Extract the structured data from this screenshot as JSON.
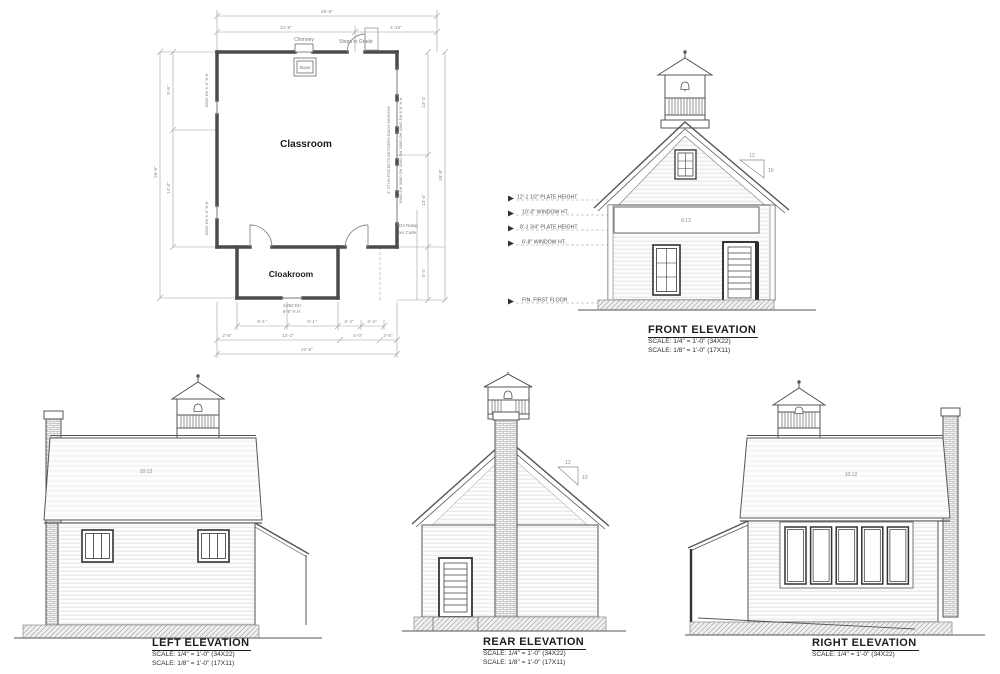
{
  "sheet": {
    "background": "#ffffff",
    "line_color": "#4b4b4b",
    "dim_color": "#9a9a9a"
  },
  "floor_plan": {
    "classroom_label": "Classroom",
    "cloakroom_label": "Cloakroom",
    "stove_label": "Stove",
    "chimney_label": "Chimney",
    "steps_label": "Steps to Grade",
    "ada_ramp_line1": "ADA Ramp",
    "ada_ramp_line2": "per Code",
    "cloak_window_line1": "24/50 DH",
    "cloak_window_line2": "6'-8\" H.H.",
    "left_window_note_top": "30/30 DH  5'-0\" H.H.",
    "left_window_note_bottom": "30/30 DH  5'-0\" H.H.",
    "right_wall_note": "3\" STUD POCKETS BETWEEN EACH WINDOW",
    "right_window_note": "30/60 DH  30/60 DH  30/60 DH  30/60 DH  30/60 DH   6'-8\" H.H.",
    "dims": {
      "top_overall": "26'-6\"",
      "top_left": "21'-8\"",
      "top_right": "4'-10\"",
      "left_outer": "26'-6\"",
      "left_seg1": "5'-6\"",
      "left_seg2": "14'-0\"",
      "right_seg1": "13'-4\"",
      "right_seg2": "13'-4\"",
      "right_lower": "4'-4\"",
      "right_outer": "26'-8\"",
      "bottom_r1_a": "6'-1\"",
      "bottom_r1_b": "6'-1\"",
      "bottom_r1_c": "2'-4\"",
      "bottom_r1_d": "2'-4\"",
      "bottom_r2_a": "2'-8\"",
      "bottom_r2_b": "12'-2\"",
      "bottom_r2_c": "5'-0\"",
      "bottom_r2_d": "2'-8\"",
      "bottom_overall": "22'-6\""
    }
  },
  "front_elevation": {
    "title": "FRONT ELEVATION",
    "scale_1": "SCALE:  1/4\" = 1'-0\" (34X22)",
    "scale_2": "SCALE:  1/8\" = 1'-0\" (17X11)",
    "band_label": "6:12",
    "pitch_rise": "12",
    "pitch_run": "10",
    "annotations": [
      "12'-1 1/2\" PLATE HEIGHT",
      "10'-0\" WINDOW HT.",
      "8'-1 3/4\" PLATE HEIGHT",
      "6'-8\" WINDOW HT.",
      "FIN. FIRST FLOOR"
    ]
  },
  "left_elevation": {
    "title": "LEFT ELEVATION",
    "scale_1": "SCALE:  1/4\" = 1'-0\" (34X22)",
    "scale_2": "SCALE:  1/8\" = 1'-0\" (17X11)",
    "roof_slope": "10:12"
  },
  "rear_elevation": {
    "title": "REAR ELEVATION",
    "scale_1": "SCALE:  1/4\" = 1'-0\" (34X22)",
    "scale_2": "SCALE:  1/8\" = 1'-0\" (17X11)",
    "pitch_rise": "12",
    "pitch_run": "10"
  },
  "right_elevation": {
    "title": "RIGHT ELEVATION",
    "scale_1": "SCALE:  1/4\" = 1'-0\" (34X22)",
    "roof_slope": "10:12"
  }
}
